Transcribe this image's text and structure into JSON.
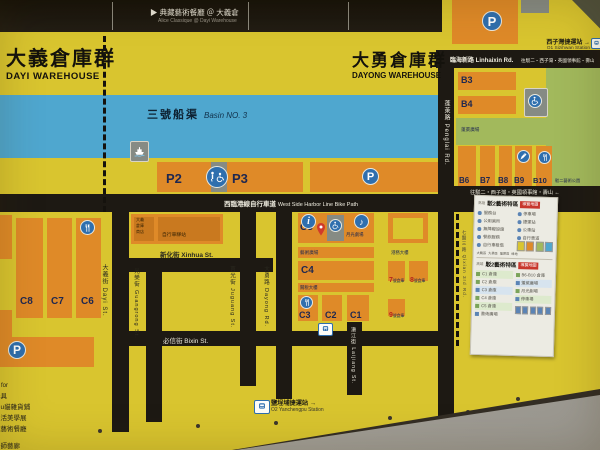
{
  "header": {
    "marker": "▶",
    "item_zh": "典藏藝術餐廳 ＠ 大義倉",
    "item_en": "Alice Classique @ Dayi Warehouse"
  },
  "zones": {
    "dayi_zh": "大義倉庫群",
    "dayi_en": "DAYI WAREHOUSE",
    "dayong_zh": "大勇倉庫群",
    "dayong_en": "DAYONG WAREHOUSE"
  },
  "basin": {
    "zh": "三號船渠",
    "en": "Basin NO. 3"
  },
  "roads": {
    "bike_zh": "西臨港線自行車道",
    "bike_en": "West Side Harbor Line Bike Path",
    "linhaixin": "臨海新路 Linhaixin Rd.",
    "direction": "往駁二・西子灣・英國領事館・壽山",
    "direction2": "往駁二・西子灣・英國領事館・壽山 ←",
    "xinhua": "新化街 Xinhua St.",
    "bixin": "必信街 Bixin St.",
    "dayi_st": "大義街 Dayi St.",
    "guangrong": "光榮街 Guangrong St.",
    "juguang": "莒光街 Juguang St.",
    "dayong_rd": "大勇路 Dayong Rd.",
    "laijiang": "瀨江街 Laijiang St.",
    "penglai": "蓬萊路 Penglai Rd.",
    "qixian": "七賢三路 Qixian 3rd Rd."
  },
  "stations": {
    "sizihwan_zh": "西子灣捷運站 →",
    "sizihwan_en": "O1 Sizihwan Station",
    "yanchengpu_zh": "鹽埕埔捷運站 →",
    "yanchengpu_en": "O2 Yanchengpu Station"
  },
  "parking": {
    "p": "P",
    "p2": "P2",
    "p3": "P3"
  },
  "blocks": {
    "c1": "C1",
    "c2": "C2",
    "c3": "C3",
    "c4": "C4",
    "c5": "C5",
    "c6": "C6",
    "c7": "C7",
    "c8": "C8",
    "b3": "B3",
    "b4": "B4",
    "b6": "B6",
    "b7": "B7",
    "b8": "B8",
    "b9": "B9",
    "b10": "B10",
    "w7": "7",
    "w8": "8",
    "w9": "9",
    "w_suffix": "號倉庫"
  },
  "labels": {
    "shop1": "大義",
    "shop2": "倉庫",
    "shop3": "商店",
    "bike_station": "自行車驛站",
    "moonlight": "月光劇場",
    "art_plaza": "藝術廣場",
    "customs": "關稅大樓",
    "tower": "港務大樓",
    "penglai_plaza": "蓬萊廣場",
    "park": "駁二藝術公園"
  },
  "tenants": [
    "er for",
    "器具",
    "lulu貓雜貨鋪",
    "生活美學展",
    "藏藝術餐廳",
    "計師藝廊"
  ],
  "legend": {
    "prefix": "高雄",
    "title": "駁2藝術特區",
    "badge": "導覽地圖",
    "s1_left": [
      "服務台",
      "公用廁所",
      "無障礙設施",
      "餐飲服務",
      "自行車租借"
    ],
    "s1_right": [
      "停車場",
      "捷運站",
      "公車站",
      "自行車道"
    ],
    "s2_left": [
      "C1 倉庫",
      "C2 倉庫",
      "C3 倉庫",
      "C4 倉庫",
      "C5 倉庫",
      "藝術廣場"
    ],
    "s2_right": [
      "B6-B10 倉庫",
      "蓬萊廣場",
      "月光劇場",
      "停車場"
    ],
    "chips": [
      "大義區",
      "大勇區",
      "蓬萊區",
      "綠地"
    ]
  },
  "colors": {
    "map_yellow": "#d9c52f",
    "block_orange": "#df8a28",
    "water_blue": "#4fa7cf",
    "road_black": "#1d1913",
    "park_green": "#a2b95c",
    "icon_blue": "#2f6fae",
    "badge_red": "#c8372d"
  }
}
